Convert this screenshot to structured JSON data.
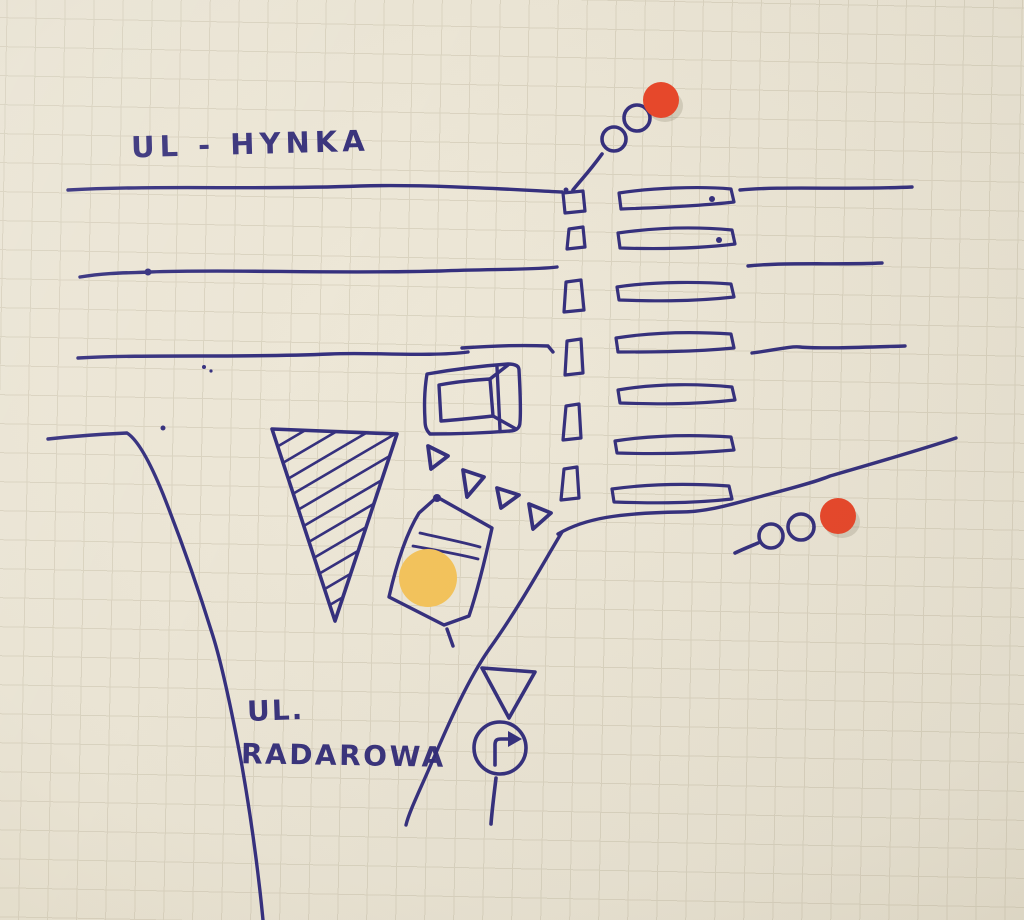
{
  "scene": {
    "kind": "hand-drawn intersection sketch on graph paper",
    "street_labels": {
      "hynka": "UL - HYNKA",
      "radarowa_line1": "UL.",
      "radarowa_line2": "RADAROWA"
    },
    "features": {
      "zebra_stripe_count": 7,
      "lane_dash_count": 6,
      "chevron_count": 4,
      "island_hatch_line_count": 13,
      "traffic_light_count": 2,
      "red_dot_count": 2,
      "yellow_dot_count": 1,
      "car_count": 2
    }
  },
  "colors": {
    "ink": "#35307e",
    "ink_text": "#312b78",
    "signal_red": "#e8482b",
    "marker_yellow": "#f4c45c",
    "paper": "#e9e3d3",
    "grid": "#c3bba4"
  }
}
